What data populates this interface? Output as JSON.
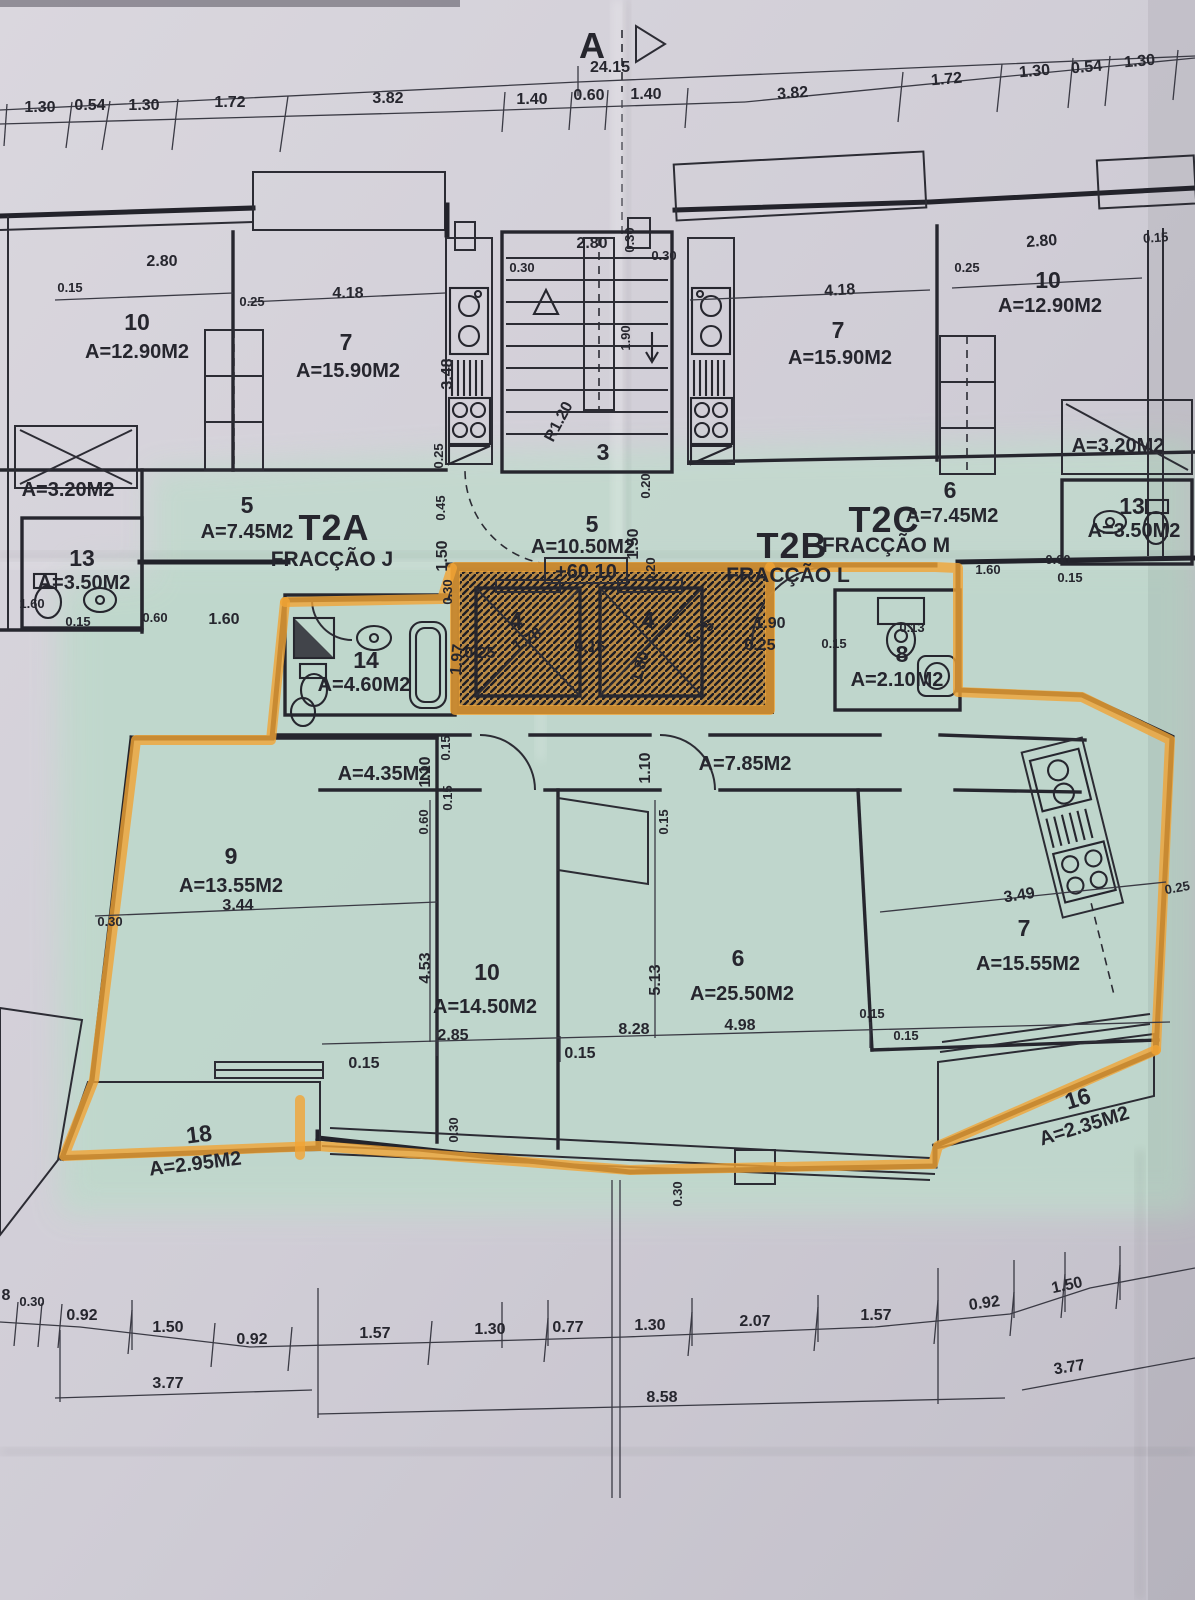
{
  "marker": {
    "letter": "A",
    "total_dim": "24.15"
  },
  "level_mark": "+60.10",
  "fractions": [
    {
      "code": "T2A",
      "name": "FRACÇÃO J"
    },
    {
      "code": "T2B",
      "name": "FRACÇÃO L"
    },
    {
      "code": "T2C",
      "name": "FRACÇÃO M"
    }
  ],
  "rooms": {
    "ul_10": {
      "n": "10",
      "a": "A=12.90M2"
    },
    "ul_7": {
      "n": "7",
      "a": "A=15.90M2"
    },
    "ul_closet": {
      "a": "A=3.20M2"
    },
    "ul_5": {
      "n": "5",
      "a": "A=7.45M2"
    },
    "ul_13": {
      "n": "13",
      "a": "A=3.50M2"
    },
    "stair": {
      "n": "3"
    },
    "hall_5": {
      "n": "5",
      "a": "A=10.50M2"
    },
    "elev_l": {
      "n": "4"
    },
    "elev_r": {
      "n": "4"
    },
    "bath_14": {
      "n": "14",
      "a": "A=4.60M2"
    },
    "ur_7": {
      "n": "7",
      "a": "A=15.90M2"
    },
    "ur_10": {
      "n": "10",
      "a": "A=12.90M2"
    },
    "ur_closet": {
      "a": "A=3.20M2"
    },
    "ur_6": {
      "n": "6",
      "a": "A=7.45M2"
    },
    "ur_13": {
      "n": "13",
      "a": "A=3.50M2"
    },
    "bath_8": {
      "n": "8",
      "a": "A=2.10M2"
    },
    "low_c1": {
      "a": "A=4.35M2"
    },
    "low_c2": {
      "a": "A=7.85M2"
    },
    "low_9": {
      "n": "9",
      "a": "A=13.55M2"
    },
    "low_10": {
      "n": "10",
      "a": "A=14.50M2"
    },
    "low_6": {
      "n": "6",
      "a": "A=25.50M2"
    },
    "low_7": {
      "n": "7",
      "a": "A=15.55M2"
    },
    "balc_18": {
      "n": "18",
      "a": "A=2.95M2"
    },
    "balc_16": {
      "n": "16",
      "a": "A=2.35M2"
    }
  },
  "dims": {
    "top_left": [
      "1.30",
      "0.54",
      "1.30",
      "1.72",
      "3.82"
    ],
    "top_center": [
      "1.40",
      "0.60",
      "1.40"
    ],
    "top_right": [
      "3.82",
      "1.72",
      "1.30",
      "0.54",
      "1.30"
    ],
    "upper_left": {
      "w015": "0.15",
      "w280": "2.80",
      "w025": "0.25",
      "w418": "4.18",
      "h348": "3.48",
      "h025": "0.25",
      "h045": "0.45",
      "h150": "1.50",
      "h030": "0.30",
      "b160a": "1.60",
      "b015": "0.15",
      "b060": "0.60",
      "b160b": "1.60"
    },
    "stair": {
      "w280": "2.80",
      "t030a": "0.30",
      "t030b": "0.30",
      "t030c": "0.30",
      "h190": "1.90",
      "r120": "R1.20"
    },
    "hall": {
      "h020a": "0.20",
      "h150": "1.50",
      "h020b": "0.20"
    },
    "elev": {
      "l025": "0.25",
      "l178": "1.78",
      "m015": "0.15",
      "r180": "1.80",
      "r175": "1.75",
      "r025": "0.25"
    },
    "bath14": {
      "h197": "1.97"
    },
    "upper_right": {
      "w418": "4.18",
      "w025": "0.25",
      "w280": "2.80",
      "w015": "0.15",
      "b160": "1.60",
      "b060": "0.60",
      "b015": "0.15",
      "w190": "1.90",
      "w015b": "0.15",
      "w013": "0.13"
    },
    "corridor": {
      "l110": "1.10",
      "l015a": "0.15",
      "l015b": "0.15",
      "l060": "0.60",
      "r110": "1.10",
      "r015": "0.15"
    },
    "lower": {
      "d344": "3.44",
      "d030": "0.30",
      "d453": "4.53",
      "d285": "2.85",
      "d015a": "0.15",
      "d513": "5.13",
      "d828": "8.28",
      "d498": "4.98",
      "d349": "3.49",
      "d025": "0.25",
      "d015b": "0.15",
      "d015c": "0.15",
      "d015d": "0.15",
      "d030b": "0.30",
      "d030c": "0.30"
    },
    "bottom_top": [
      "8",
      "0.30",
      "0.92",
      "1.50",
      "0.92",
      "1.57",
      "1.30",
      "0.77",
      "1.30",
      "2.07",
      "1.57",
      "0.92",
      "1.50"
    ],
    "bottom_low": [
      "3.77",
      "8.58",
      "3.77"
    ]
  }
}
